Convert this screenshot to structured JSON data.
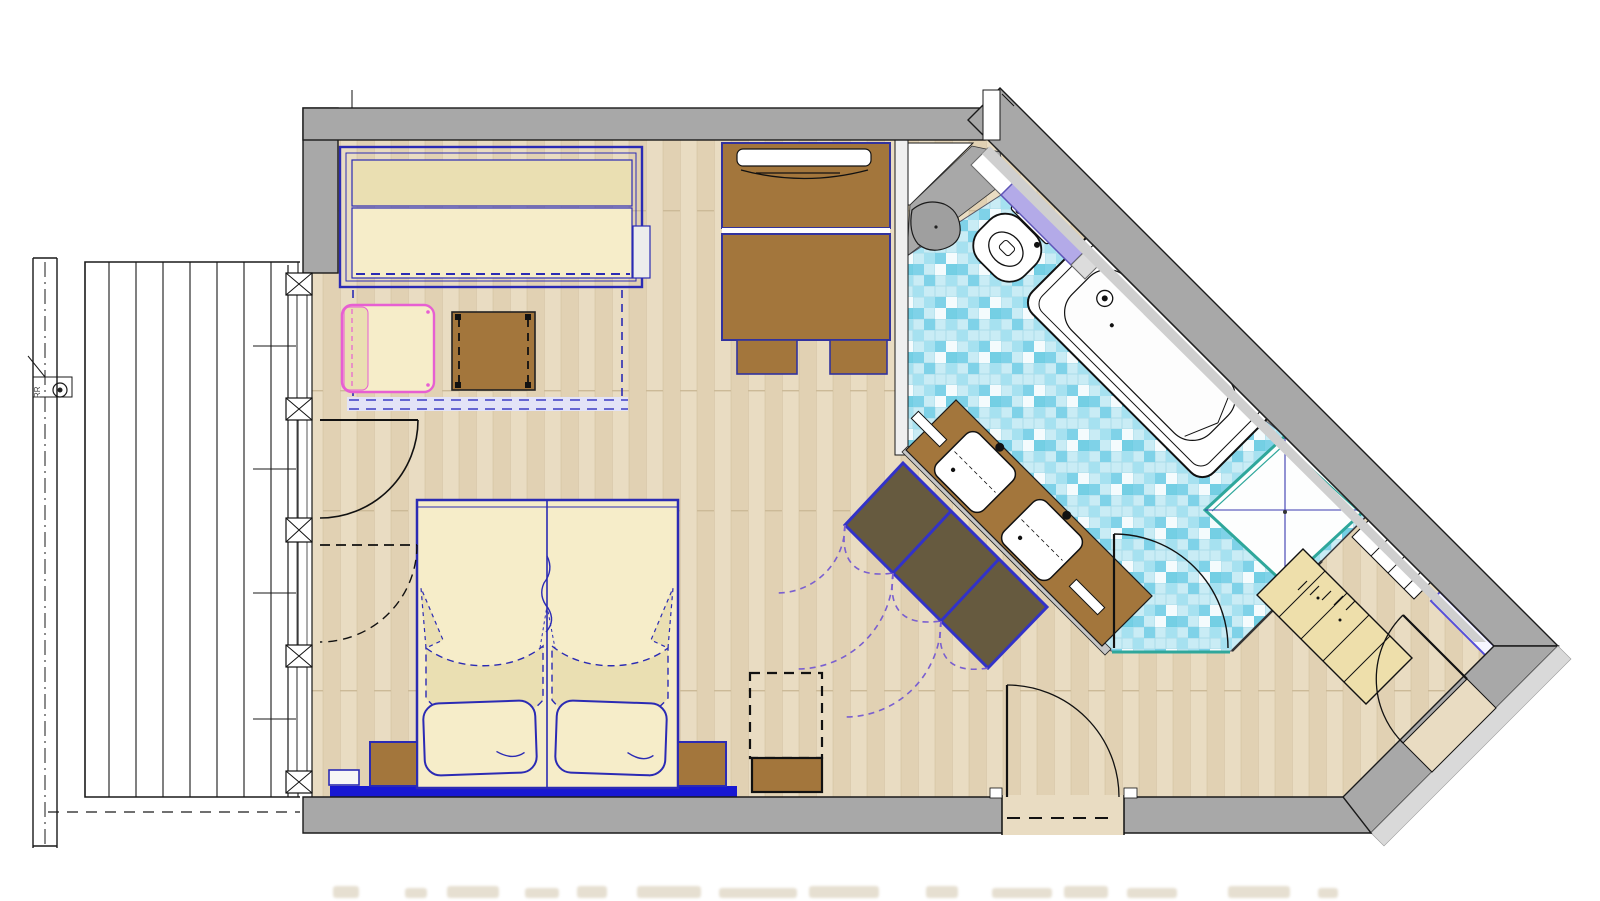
{
  "meta": {
    "type": "architectural-floor-plan",
    "depicts": "hotel room floor plan with balcony, bedroom-living area, bathroom and entry hall"
  },
  "labels": {
    "downpipe": "RR"
  },
  "colors": {
    "wall": "#a8a8a8",
    "wallLight": "#d9d9d9",
    "line": "#1a1a1a",
    "wood1": "#e9dcc2",
    "wood2": "#e1d1b3",
    "woodSeam": "#ccba98",
    "deckLine": "#2b2b2b",
    "tileBase": "#c9ecf5",
    "tileA": "#7fd2e8",
    "tileB": "#a6e1f0",
    "tileC": "#f4fbfd",
    "tileD": "#5fc8e0",
    "tileGrid": "#aadce9",
    "blue": "#2b2bb4",
    "blueBright": "#1717d2",
    "indigoEdge": "#32329e",
    "cream": "#f6edc9",
    "creamDark": "#eadfb2",
    "brown": "#a3763c",
    "darkBrown": "#665a3f",
    "pink": "#e75fd2",
    "teal": "#2fa79b",
    "lavender": "#b3aae8",
    "mirrorEdge": "#564fd8",
    "purple": "#7a5fd0",
    "tan": "#eedfab",
    "captionFaint": "#ded5c2"
  },
  "elements": [
    "balcony-deck",
    "balcony-railing",
    "rain-downpipe",
    "window-wall",
    "window-posts",
    "balcony-double-door",
    "sofa-bed",
    "armchair",
    "coffee-table",
    "tv-sideboard",
    "desk",
    "desk-chairs",
    "double-bed",
    "pillows",
    "nightstands",
    "bed-platform",
    "luggage-rack",
    "wardrobe-3-door",
    "vanity-two-sinks",
    "toilet",
    "bathtub",
    "shower",
    "wall-shelf",
    "bathroom-door",
    "room-door",
    "entry-door",
    "entry-closet",
    "shelf-strip",
    "mirror"
  ]
}
